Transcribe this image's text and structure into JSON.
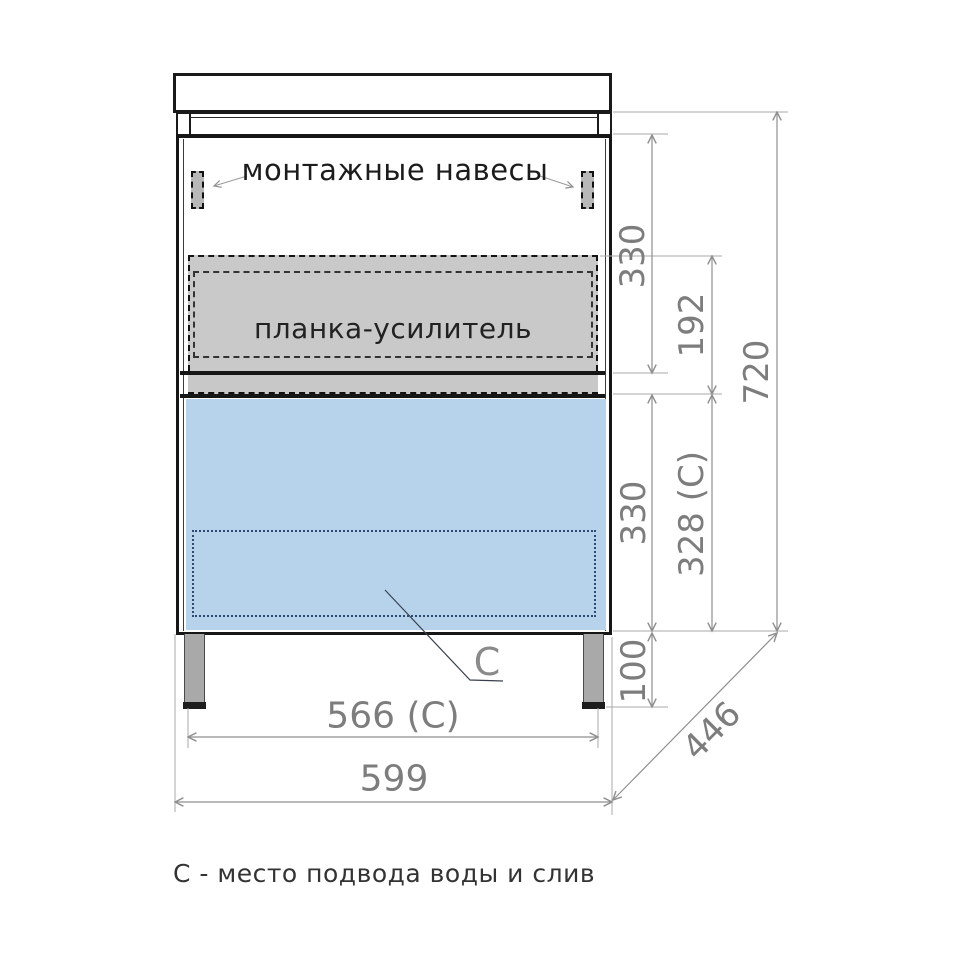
{
  "drawing": {
    "labels": {
      "mounting_hangers": "монтажные навесы",
      "reinforcement_bar": "планка-усилитель",
      "connection_marker": "С",
      "legend": "С - место подвода воды и слив"
    },
    "dimensions": {
      "upper_section_height": "330",
      "reinforcement_zone_height": "192",
      "total_height": "720",
      "lower_section_height": "330",
      "connection_zone_height": "328 (С)",
      "leg_height": "100",
      "connection_zone_width": "566 (С)",
      "total_width": "599",
      "depth": "446"
    },
    "colors": {
      "outline": "#1a1a1a",
      "dimension_text": "#7d7d7d",
      "dimension_line": "#8f8f8f",
      "reinforcement_fill": "#c9c9c9",
      "drawer_fill": "#b7d3ec",
      "leg_fill": "#a9a9a9",
      "hanger_fill": "#b8b8b8",
      "connection_dotted": "#2b4a6f"
    }
  }
}
